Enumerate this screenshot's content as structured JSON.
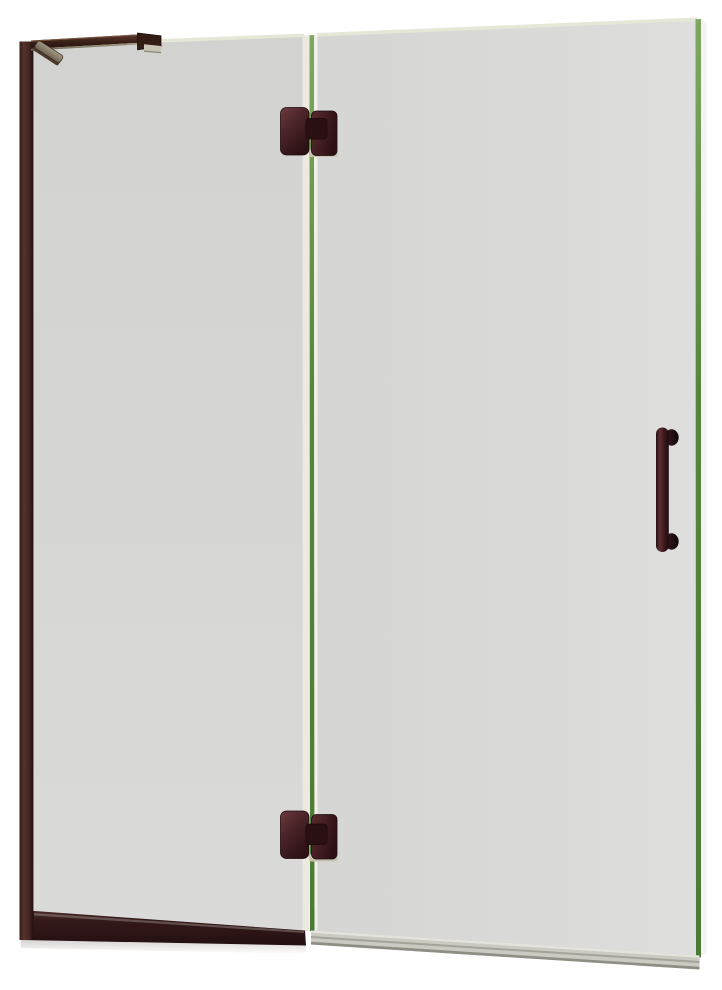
{
  "image": {
    "kind": "product-photo",
    "subject": "Frameless hinged glass shower door with clear glass panels and oil-rubbed bronze hardware",
    "width_px": 722,
    "height_px": 990
  },
  "colors": {
    "background": "#ffffff",
    "glass-fixed": "#d6d6d4",
    "glass-door": "#dadad8",
    "glass-top-edge": "#e4e9d7",
    "glass-edge-green": "#55863d",
    "glass-edge-green-light": "#7fa763",
    "glass-edge-highlight": "#f1f0e7",
    "glass-edge-strip": "#ece9df",
    "bronze-darkest": "#1f0b0f",
    "bronze-dark": "#2c1214",
    "bronze-mid": "#4a2428",
    "bronze-light": "#6b373c",
    "profile-highlight": "#56322c",
    "metal-tan": "#8e8878",
    "hinge-plate": "#c8c2af",
    "sill-gray": "#cbcac2",
    "sill-line": "#a4a399",
    "sill-shadow": "#8f8e85",
    "clamp-notch": "#c9c4b3"
  },
  "components": {
    "wall_profile": {
      "label": "Wall mounting profile"
    },
    "support_bar": {
      "label": "Top support bar"
    },
    "wall_bracket": {
      "label": "Support bar wall bracket"
    },
    "glass_clamp": {
      "label": "Support bar glass clamp"
    },
    "fixed_panel": {
      "label": "Fixed glass panel"
    },
    "door_panel": {
      "label": "Hinged glass door panel"
    },
    "center_gap": {
      "label": "Glass edge seam between panels"
    },
    "top_hinge": {
      "label": "Top pivot hinge"
    },
    "bottom_hinge": {
      "label": "Bottom pivot hinge"
    },
    "handle": {
      "label": "Door pull handle"
    },
    "bottom_rail": {
      "label": "Fixed panel bottom rail"
    },
    "door_sweep": {
      "label": "Door bottom sweep"
    }
  }
}
